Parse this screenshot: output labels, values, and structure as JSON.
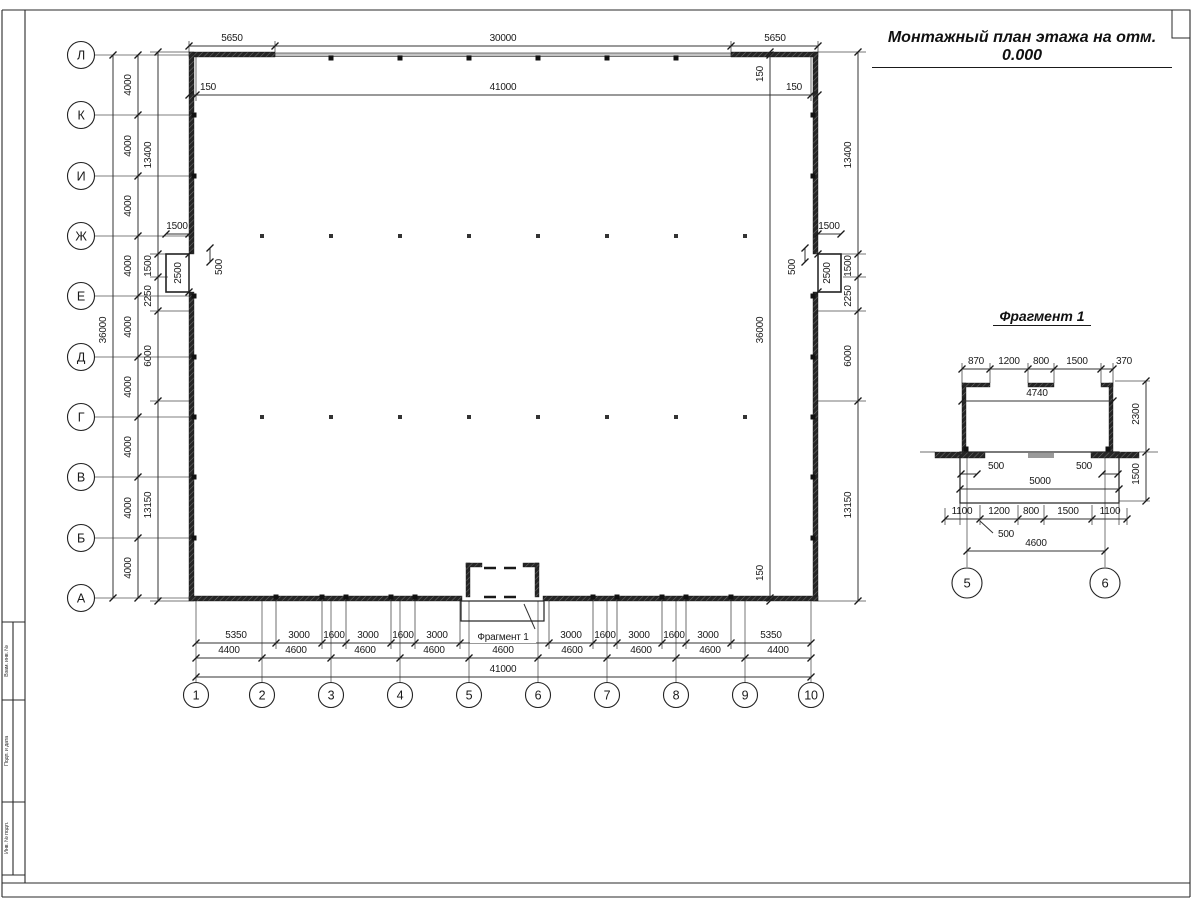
{
  "meta": {
    "title": "Монтажный план этажа на отм. 0.000",
    "fragment_title": "Фрагмент 1",
    "fragment_ref": "Фрагмент 1"
  },
  "frame": {
    "lines": [
      [
        2,
        10,
        1190,
        10
      ],
      [
        1190,
        10,
        1190,
        897
      ],
      [
        2,
        10,
        2,
        897
      ],
      [
        2,
        897,
        1190,
        897
      ],
      [
        2,
        883,
        1190,
        883
      ],
      [
        25,
        10,
        25,
        883
      ],
      [
        2,
        622,
        25,
        622
      ],
      [
        2,
        700,
        25,
        700
      ],
      [
        2,
        802,
        25,
        802
      ],
      [
        2,
        875,
        25,
        875
      ],
      [
        13,
        622,
        13,
        875
      ]
    ],
    "code_box": [
      1172,
      10,
      18,
      28
    ],
    "stamp_labels": [
      {
        "t": "Взам. инв. №",
        "x": 8,
        "y": 661
      },
      {
        "t": "Подп. и дата",
        "x": 8,
        "y": 751
      },
      {
        "t": "Инв. № подл.",
        "x": 8,
        "y": 838
      }
    ]
  },
  "axes": {
    "rows": [
      {
        "label": "Л",
        "y": 55
      },
      {
        "label": "К",
        "y": 115
      },
      {
        "label": "И",
        "y": 176
      },
      {
        "label": "Ж",
        "y": 236
      },
      {
        "label": "Е",
        "y": 296
      },
      {
        "label": "Д",
        "y": 357
      },
      {
        "label": "Г",
        "y": 417
      },
      {
        "label": "В",
        "y": 477
      },
      {
        "label": "Б",
        "y": 538
      },
      {
        "label": "А",
        "y": 598
      }
    ],
    "cols": [
      {
        "label": "1",
        "x": 196
      },
      {
        "label": "2",
        "x": 262
      },
      {
        "label": "3",
        "x": 331
      },
      {
        "label": "4",
        "x": 400
      },
      {
        "label": "5",
        "x": 469
      },
      {
        "label": "6",
        "x": 538
      },
      {
        "label": "7",
        "x": 607
      },
      {
        "label": "8",
        "x": 676
      },
      {
        "label": "9",
        "x": 745
      },
      {
        "label": "10",
        "x": 811
      }
    ],
    "frag": [
      {
        "label": "5",
        "x": 967
      },
      {
        "label": "6",
        "x": 1105
      }
    ],
    "row_circle": {
      "cx": 81,
      "r": 13.5
    },
    "col_circle": {
      "cy": 695,
      "r": 12.5
    },
    "frag_circle": {
      "cy": 583,
      "r": 15
    }
  },
  "walls": {
    "solid": [
      [
        189,
        52,
        86,
        5
      ],
      [
        731,
        52,
        87,
        5
      ],
      [
        189,
        52,
        5,
        202
      ],
      [
        189,
        292,
        5,
        309
      ],
      [
        813,
        52,
        5,
        202
      ],
      [
        813,
        292,
        5,
        309
      ],
      [
        189,
        596,
        273,
        5
      ],
      [
        543,
        596,
        275,
        5
      ],
      [
        466,
        563,
        4,
        34
      ],
      [
        535,
        563,
        4,
        34
      ],
      [
        466,
        563,
        16,
        4
      ],
      [
        523,
        563,
        16,
        4
      ],
      [
        962,
        383,
        4,
        69
      ],
      [
        1109,
        383,
        4,
        69
      ],
      [
        962,
        383,
        28,
        4
      ],
      [
        1028,
        383,
        26,
        4
      ],
      [
        1101,
        383,
        12,
        4
      ],
      [
        935,
        452,
        50,
        6
      ],
      [
        1091,
        452,
        48,
        6
      ]
    ],
    "thin": [
      [
        275,
        53,
        456,
        3.5
      ]
    ],
    "outline": [
      [
        166,
        254,
        23,
        38,
        1.6
      ],
      [
        818,
        254,
        23,
        38,
        1.6
      ],
      [
        461,
        601,
        83,
        20,
        1.2
      ],
      [
        960,
        452,
        159,
        51,
        1.2
      ]
    ],
    "gray": [
      [
        1028,
        453,
        26,
        5
      ]
    ],
    "squares": [
      [
        331,
        58
      ],
      [
        400,
        58
      ],
      [
        469,
        58
      ],
      [
        538,
        58
      ],
      [
        607,
        58
      ],
      [
        676,
        58
      ],
      [
        194,
        115
      ],
      [
        194,
        176
      ],
      [
        194,
        296
      ],
      [
        194,
        357
      ],
      [
        194,
        417
      ],
      [
        194,
        477
      ],
      [
        194,
        538
      ],
      [
        813,
        115
      ],
      [
        813,
        176
      ],
      [
        813,
        296
      ],
      [
        813,
        357
      ],
      [
        813,
        417
      ],
      [
        813,
        477
      ],
      [
        813,
        538
      ],
      [
        276,
        597
      ],
      [
        322,
        597
      ],
      [
        346,
        597
      ],
      [
        391,
        597
      ],
      [
        415,
        597
      ],
      [
        593,
        597
      ],
      [
        617,
        597
      ],
      [
        662,
        597
      ],
      [
        686,
        597
      ],
      [
        731,
        597
      ],
      [
        966,
        449
      ],
      [
        1108,
        449
      ]
    ],
    "dots": {
      "rows": [
        236,
        417
      ],
      "xs": [
        262,
        331,
        400,
        469,
        538,
        607,
        676,
        745
      ]
    },
    "dashes": [
      [
        484,
        568,
        522,
        568
      ],
      [
        484,
        597,
        522,
        597
      ]
    ]
  },
  "lines": {
    "axis": [
      [
        967,
        452,
        967,
        567
      ],
      [
        1105,
        452,
        1105,
        567
      ]
    ],
    "ext": [
      [
        275,
        52,
        275,
        41
      ],
      [
        731,
        52,
        731,
        41
      ],
      [
        189,
        52,
        189,
        41
      ],
      [
        818,
        52,
        818,
        41
      ],
      [
        196,
        57,
        196,
        101
      ],
      [
        811,
        57,
        811,
        101
      ],
      [
        276,
        601,
        276,
        649
      ],
      [
        322,
        601,
        322,
        649
      ],
      [
        346,
        601,
        346,
        649
      ],
      [
        391,
        601,
        391,
        649
      ],
      [
        415,
        601,
        415,
        649
      ],
      [
        460,
        601,
        460,
        649
      ],
      [
        549,
        601,
        549,
        649
      ],
      [
        593,
        601,
        593,
        649
      ],
      [
        617,
        601,
        617,
        649
      ],
      [
        662,
        601,
        662,
        649
      ],
      [
        686,
        601,
        686,
        649
      ],
      [
        731,
        601,
        731,
        649
      ],
      [
        150,
        52,
        189,
        52
      ],
      [
        818,
        52,
        866,
        52
      ],
      [
        150,
        254,
        166,
        254
      ],
      [
        841,
        254,
        866,
        254
      ],
      [
        150,
        277,
        168,
        277
      ],
      [
        843,
        277,
        866,
        277
      ],
      [
        150,
        311,
        189,
        311
      ],
      [
        818,
        311,
        866,
        311
      ],
      [
        150,
        401,
        189,
        401
      ],
      [
        818,
        401,
        866,
        401
      ],
      [
        150,
        601,
        189,
        601
      ],
      [
        818,
        601,
        866,
        601
      ],
      [
        962,
        383,
        962,
        363
      ],
      [
        990,
        383,
        990,
        363
      ],
      [
        1028,
        383,
        1028,
        363
      ],
      [
        1054,
        383,
        1054,
        363
      ],
      [
        1101,
        383,
        1101,
        363
      ],
      [
        1113,
        383,
        1113,
        363
      ],
      [
        920,
        452,
        935,
        452
      ],
      [
        1139,
        452,
        1158,
        452
      ],
      [
        960,
        503,
        960,
        525
      ],
      [
        1119,
        503,
        1119,
        525
      ],
      [
        945,
        508,
        945,
        525
      ],
      [
        980,
        505,
        980,
        525
      ],
      [
        1018,
        505,
        1018,
        525
      ],
      [
        1044,
        505,
        1044,
        525
      ],
      [
        1092,
        505,
        1092,
        525
      ],
      [
        1127,
        508,
        1127,
        525
      ],
      [
        1115,
        381,
        1150,
        381
      ],
      [
        1119,
        501,
        1150,
        501
      ]
    ],
    "leader": [
      [
        524,
        604,
        535,
        629
      ],
      [
        980,
        521,
        993,
        533
      ]
    ]
  },
  "hdims": [
    {
      "y": 46,
      "x1": 189,
      "x2": 818,
      "ticks": [
        189,
        275,
        731,
        818
      ],
      "labels": [
        {
          "t": "5650",
          "x": 232
        },
        {
          "t": "30000",
          "x": 503
        },
        {
          "t": "5650",
          "x": 775
        }
      ]
    },
    {
      "y": 95,
      "x1": 189,
      "x2": 818,
      "ticks": [
        189,
        196,
        811,
        818
      ],
      "labels": [
        {
          "t": "150",
          "x": 208
        },
        {
          "t": "41000",
          "x": 503
        },
        {
          "t": "150",
          "x": 794
        }
      ]
    },
    {
      "y": 234,
      "x1": 166,
      "x2": 189,
      "ticks": [
        166,
        189
      ],
      "labels": [
        {
          "t": "1500",
          "x": 177
        }
      ]
    },
    {
      "y": 234,
      "x1": 818,
      "x2": 841,
      "ticks": [
        818,
        841
      ],
      "labels": [
        {
          "t": "1500",
          "x": 829
        }
      ]
    },
    {
      "y": 643,
      "x1": 196,
      "x2": 811,
      "ticks": [
        196,
        276,
        322,
        346,
        391,
        415,
        460,
        549,
        593,
        617,
        662,
        686,
        731,
        811
      ],
      "labels": [
        {
          "t": "5350",
          "x": 236
        },
        {
          "t": "3000",
          "x": 299
        },
        {
          "t": "1600",
          "x": 334
        },
        {
          "t": "3000",
          "x": 368
        },
        {
          "t": "1600",
          "x": 403
        },
        {
          "t": "3000",
          "x": 437
        },
        {
          "t": "3000",
          "x": 571
        },
        {
          "t": "1600",
          "x": 605
        },
        {
          "t": "3000",
          "x": 639
        },
        {
          "t": "1600",
          "x": 674
        },
        {
          "t": "3000",
          "x": 708
        },
        {
          "t": "5350",
          "x": 771
        }
      ]
    },
    {
      "y": 658,
      "x1": 196,
      "x2": 811,
      "ticks": [
        196,
        262,
        331,
        400,
        469,
        538,
        607,
        676,
        745,
        811
      ],
      "labels": [
        {
          "t": "4400",
          "x": 229
        },
        {
          "t": "4600",
          "x": 296
        },
        {
          "t": "4600",
          "x": 365
        },
        {
          "t": "4600",
          "x": 434
        },
        {
          "t": "4600",
          "x": 503
        },
        {
          "t": "4600",
          "x": 572
        },
        {
          "t": "4600",
          "x": 641
        },
        {
          "t": "4600",
          "x": 710
        },
        {
          "t": "4400",
          "x": 778
        }
      ]
    },
    {
      "y": 677,
      "x1": 196,
      "x2": 811,
      "ticks": [
        196,
        811
      ],
      "labels": [
        {
          "t": "41000",
          "x": 503
        }
      ]
    },
    {
      "y": 369,
      "x1": 962,
      "x2": 1113,
      "ticks": [
        962,
        990,
        1028,
        1054,
        1101,
        1113
      ],
      "labels": [
        {
          "t": "870",
          "x": 976
        },
        {
          "t": "1200",
          "x": 1009
        },
        {
          "t": "800",
          "x": 1041
        },
        {
          "t": "1500",
          "x": 1077
        },
        {
          "t": "370",
          "x": 1124
        }
      ]
    },
    {
      "y": 401,
      "x1": 962,
      "x2": 1113,
      "ticks": [
        962,
        1113
      ],
      "labels": [
        {
          "t": "4740",
          "x": 1037
        }
      ]
    },
    {
      "y": 474,
      "x1": 961,
      "x2": 977,
      "ticks": [
        961,
        977
      ],
      "labels": [
        {
          "t": "500",
          "x": 996
        }
      ]
    },
    {
      "y": 474,
      "x1": 1102,
      "x2": 1118,
      "ticks": [
        1102,
        1118
      ],
      "labels": [
        {
          "t": "500",
          "x": 1084
        }
      ]
    },
    {
      "y": 489,
      "x1": 960,
      "x2": 1119,
      "ticks": [
        960,
        1119
      ],
      "labels": [
        {
          "t": "5000",
          "x": 1040
        }
      ]
    },
    {
      "y": 519,
      "x1": 945,
      "x2": 1127,
      "ticks": [
        945,
        980,
        1018,
        1044,
        1092,
        1127
      ],
      "labels": [
        {
          "t": "1100",
          "x": 962
        },
        {
          "t": "1200",
          "x": 999
        },
        {
          "t": "800",
          "x": 1031
        },
        {
          "t": "1500",
          "x": 1068
        },
        {
          "t": "1100",
          "x": 1110
        }
      ]
    },
    {
      "y": 551,
      "x1": 967,
      "x2": 1105,
      "ticks": [
        967,
        1105
      ],
      "labels": [
        {
          "t": "4600",
          "x": 1036
        }
      ]
    }
  ],
  "vdims": [
    {
      "x": 113,
      "y1": 55,
      "y2": 598,
      "ticks": [
        55,
        598
      ],
      "lx": 106,
      "labels": [
        {
          "t": "36000",
          "y": 330
        }
      ]
    },
    {
      "x": 138,
      "y1": 55,
      "y2": 598,
      "ticks": [
        55,
        115,
        176,
        236,
        296,
        357,
        417,
        477,
        538,
        598
      ],
      "lx": 131,
      "labels": [
        {
          "t": "4000",
          "y": 85
        },
        {
          "t": "4000",
          "y": 146
        },
        {
          "t": "4000",
          "y": 206
        },
        {
          "t": "4000",
          "y": 266
        },
        {
          "t": "4000",
          "y": 327
        },
        {
          "t": "4000",
          "y": 387
        },
        {
          "t": "4000",
          "y": 447
        },
        {
          "t": "4000",
          "y": 508
        },
        {
          "t": "4000",
          "y": 568
        }
      ]
    },
    {
      "x": 158,
      "y1": 52,
      "y2": 601,
      "ticks": [
        52,
        254,
        277,
        311,
        401,
        601
      ],
      "lx": 151,
      "labels": [
        {
          "t": "13400",
          "y": 155
        },
        {
          "t": "1500",
          "y": 266
        },
        {
          "t": "2250",
          "y": 296
        },
        {
          "t": "6000",
          "y": 356
        },
        {
          "t": "13150",
          "y": 505
        }
      ]
    },
    {
      "x": 770,
      "y1": 52,
      "y2": 601,
      "ticks": [
        52,
        55,
        598,
        601
      ],
      "lx": 763,
      "labels": [
        {
          "t": "150",
          "y": 74
        },
        {
          "t": "36000",
          "y": 330
        },
        {
          "t": "150",
          "y": 573
        }
      ]
    },
    {
      "x": 858,
      "y1": 52,
      "y2": 601,
      "ticks": [
        52,
        254,
        277,
        311,
        401,
        601
      ],
      "lx": 851,
      "labels": [
        {
          "t": "13400",
          "y": 155
        },
        {
          "t": "1500",
          "y": 266
        },
        {
          "t": "2250",
          "y": 296
        },
        {
          "t": "6000",
          "y": 356
        },
        {
          "t": "13150",
          "y": 505
        }
      ]
    },
    {
      "x": 210,
      "y1": 248,
      "y2": 262,
      "ticks": [
        248,
        262
      ],
      "lx": 222,
      "labels": [
        {
          "t": "500",
          "y": 267
        }
      ]
    },
    {
      "x": 805,
      "y1": 248,
      "y2": 262,
      "ticks": [
        248,
        262
      ],
      "lx": 795,
      "labels": [
        {
          "t": "500",
          "y": 267
        }
      ]
    },
    {
      "x": 189,
      "y1": 254,
      "y2": 292,
      "ticks": [
        254,
        292
      ],
      "lx": 181,
      "labels": [
        {
          "t": "2500",
          "y": 273
        }
      ]
    },
    {
      "x": 818,
      "y1": 254,
      "y2": 292,
      "ticks": [
        254,
        292
      ],
      "lx": 830,
      "labels": [
        {
          "t": "2500",
          "y": 273
        }
      ]
    },
    {
      "x": 1146,
      "y1": 381,
      "y2": 501,
      "ticks": [
        381,
        452,
        501
      ],
      "lx": 1139,
      "labels": [
        {
          "t": "2300",
          "y": 414
        },
        {
          "t": "1500",
          "y": 474
        }
      ]
    }
  ],
  "texts": [
    {
      "t": "Фрагмент 1",
      "x": 503,
      "y": 640,
      "size": 10,
      "bg": true,
      "dn": "fragment-ref-label"
    },
    {
      "t": "500",
      "x": 1006,
      "y": 537,
      "size": 10,
      "dn": "dim-label"
    }
  ]
}
